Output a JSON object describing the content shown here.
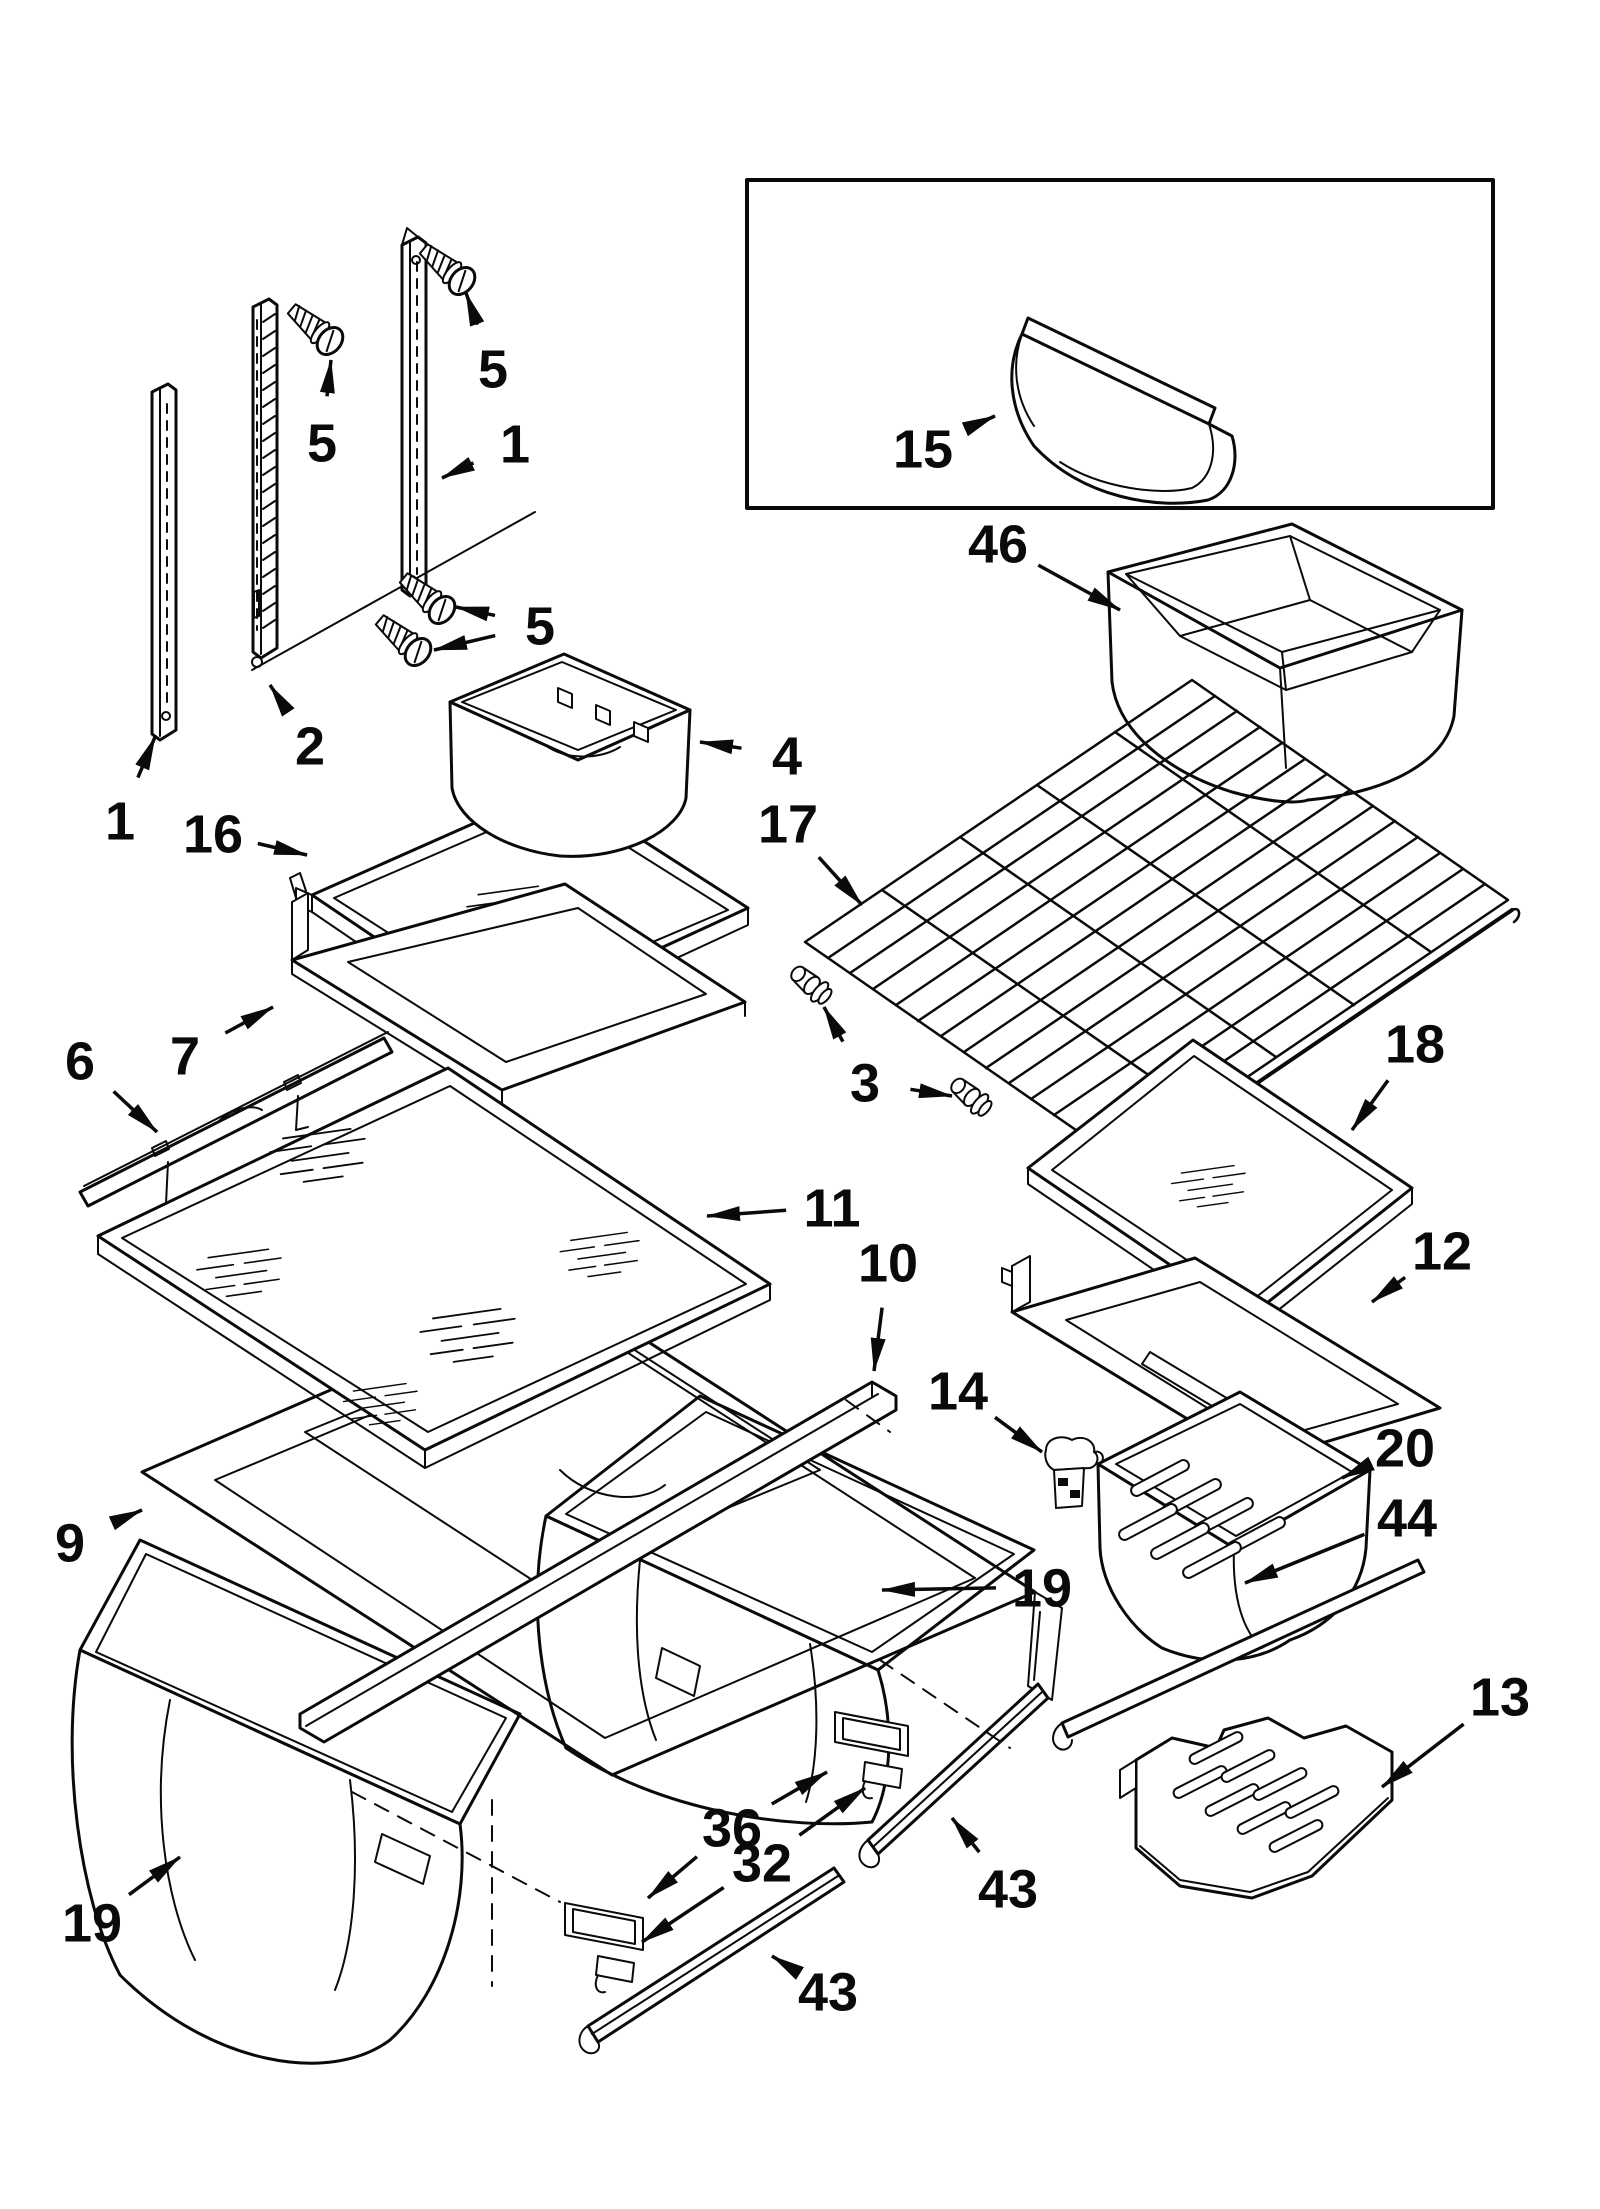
{
  "diagram": {
    "figure_type": "exploded-parts-diagram",
    "canvas": {
      "width": 1600,
      "height": 2209,
      "background": "#ffffff",
      "line_color": "#0a0a0a"
    },
    "inset_box": {
      "x": 747,
      "y": 180,
      "width": 746,
      "height": 328
    },
    "callouts": [
      {
        "label": "5",
        "x": 493,
        "y": 368,
        "targets": [
          [
            466,
            293
          ]
        ]
      },
      {
        "label": "1",
        "x": 515,
        "y": 443,
        "targets": [
          [
            442,
            478
          ]
        ]
      },
      {
        "label": "5",
        "x": 322,
        "y": 442,
        "targets": [
          [
            331,
            360
          ]
        ]
      },
      {
        "label": "5",
        "x": 540,
        "y": 625,
        "targets": [
          [
            456,
            607
          ],
          [
            434,
            650
          ]
        ]
      },
      {
        "label": "2",
        "x": 310,
        "y": 745,
        "targets": [
          [
            270,
            685
          ]
        ]
      },
      {
        "label": "1",
        "x": 120,
        "y": 820,
        "targets": [
          [
            155,
            737
          ]
        ]
      },
      {
        "label": "16",
        "x": 213,
        "y": 833,
        "targets": [
          [
            307,
            855
          ]
        ]
      },
      {
        "label": "4",
        "x": 787,
        "y": 755,
        "targets": [
          [
            700,
            742
          ]
        ]
      },
      {
        "label": "15",
        "x": 923,
        "y": 448,
        "targets": [
          [
            995,
            416
          ]
        ]
      },
      {
        "label": "46",
        "x": 998,
        "y": 543,
        "targets": [
          [
            1120,
            610
          ]
        ]
      },
      {
        "label": "17",
        "x": 788,
        "y": 823,
        "targets": [
          [
            862,
            905
          ]
        ]
      },
      {
        "label": "3",
        "x": 865,
        "y": 1082,
        "targets": [
          [
            824,
            1007
          ],
          [
            952,
            1096
          ]
        ]
      },
      {
        "label": "6",
        "x": 80,
        "y": 1060,
        "targets": [
          [
            157,
            1132
          ]
        ]
      },
      {
        "label": "7",
        "x": 185,
        "y": 1055,
        "targets": [
          [
            273,
            1007
          ]
        ]
      },
      {
        "label": "11",
        "x": 832,
        "y": 1207,
        "targets": [
          [
            707,
            1216
          ]
        ]
      },
      {
        "label": "10",
        "x": 888,
        "y": 1262,
        "targets": [
          [
            874,
            1371
          ]
        ]
      },
      {
        "label": "18",
        "x": 1415,
        "y": 1043,
        "targets": [
          [
            1352,
            1130
          ]
        ]
      },
      {
        "label": "12",
        "x": 1442,
        "y": 1250,
        "targets": [
          [
            1372,
            1302
          ]
        ]
      },
      {
        "label": "14",
        "x": 958,
        "y": 1390,
        "targets": [
          [
            1042,
            1452
          ]
        ]
      },
      {
        "label": "20",
        "x": 1405,
        "y": 1447,
        "targets": [
          [
            1342,
            1478
          ]
        ]
      },
      {
        "label": "44",
        "x": 1407,
        "y": 1517,
        "targets": [
          [
            1245,
            1583
          ]
        ]
      },
      {
        "label": "19",
        "x": 1042,
        "y": 1587,
        "targets": [
          [
            882,
            1590
          ]
        ]
      },
      {
        "label": "9",
        "x": 70,
        "y": 1542,
        "targets": [
          [
            142,
            1510
          ]
        ]
      },
      {
        "label": "13",
        "x": 1500,
        "y": 1696,
        "targets": [
          [
            1382,
            1787
          ]
        ]
      },
      {
        "label": "36",
        "x": 732,
        "y": 1827,
        "targets": [
          [
            827,
            1772
          ],
          [
            648,
            1898
          ]
        ]
      },
      {
        "label": "32",
        "x": 762,
        "y": 1862,
        "targets": [
          [
            865,
            1788
          ],
          [
            642,
            1942
          ]
        ]
      },
      {
        "label": "43",
        "x": 1008,
        "y": 1888,
        "targets": [
          [
            952,
            1818
          ]
        ]
      },
      {
        "label": "43",
        "x": 828,
        "y": 1991,
        "targets": [
          [
            772,
            1956
          ]
        ]
      },
      {
        "label": "19",
        "x": 92,
        "y": 1922,
        "targets": [
          [
            180,
            1857
          ]
        ]
      }
    ]
  }
}
